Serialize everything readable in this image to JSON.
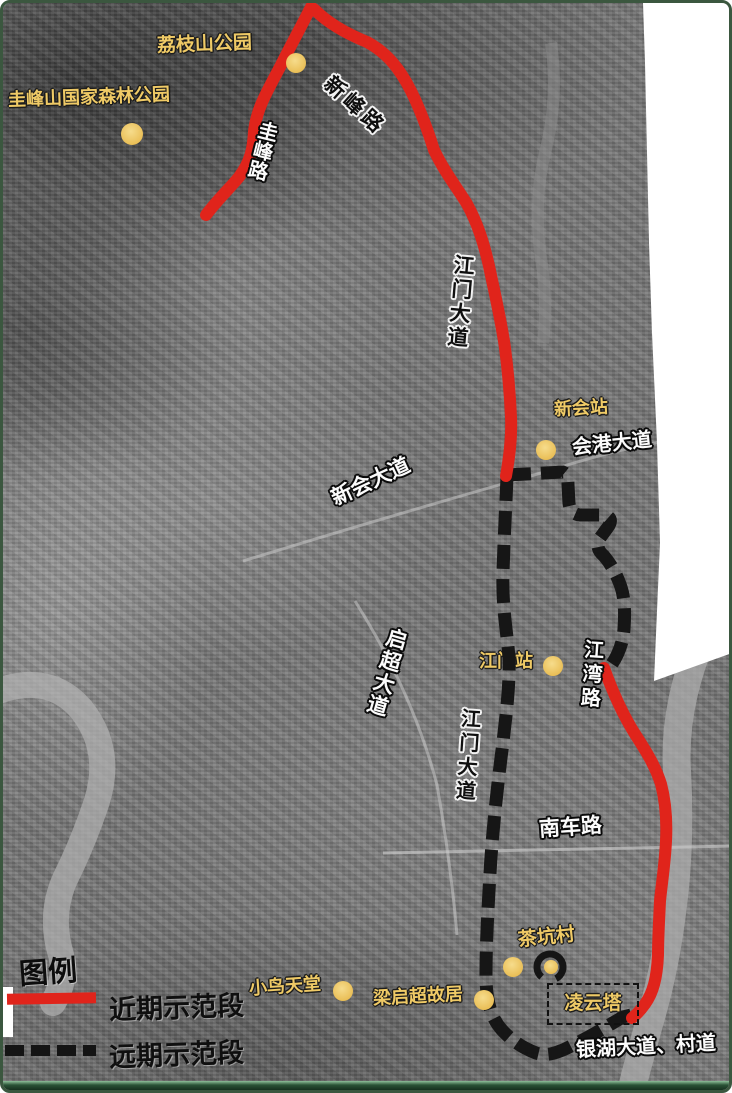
{
  "legend": {
    "title": "图例",
    "items": [
      {
        "label": "近期示范段",
        "line_style": "solid",
        "color": "#e0241b"
      },
      {
        "label": "远期示范段",
        "line_style": "dashed",
        "color": "#141414"
      }
    ]
  },
  "roads": [
    {
      "label": "圭峰路"
    },
    {
      "label": "新峰路"
    },
    {
      "label": "江门大道"
    },
    {
      "label": "会港大道"
    },
    {
      "label": "新会大道"
    },
    {
      "label": "启超大道"
    },
    {
      "label": "江湾路"
    },
    {
      "label": "江门大道"
    },
    {
      "label": "南车路"
    },
    {
      "label": "银湖大道、村道"
    }
  ],
  "pois": [
    {
      "label": "荔枝山公园"
    },
    {
      "label": "圭峰山国家森林公园"
    },
    {
      "label": "新会站"
    },
    {
      "label": "江门站"
    },
    {
      "label": "茶坑村"
    },
    {
      "label": "小鸟天堂"
    },
    {
      "label": "梁启超故居"
    },
    {
      "label": "凌云塔"
    }
  ],
  "colors": {
    "near_route": "#e0241b",
    "far_route": "#161616",
    "poi_marker": "#eec863",
    "blank_area": "#ffffff",
    "frame_green": "#3b573f"
  }
}
